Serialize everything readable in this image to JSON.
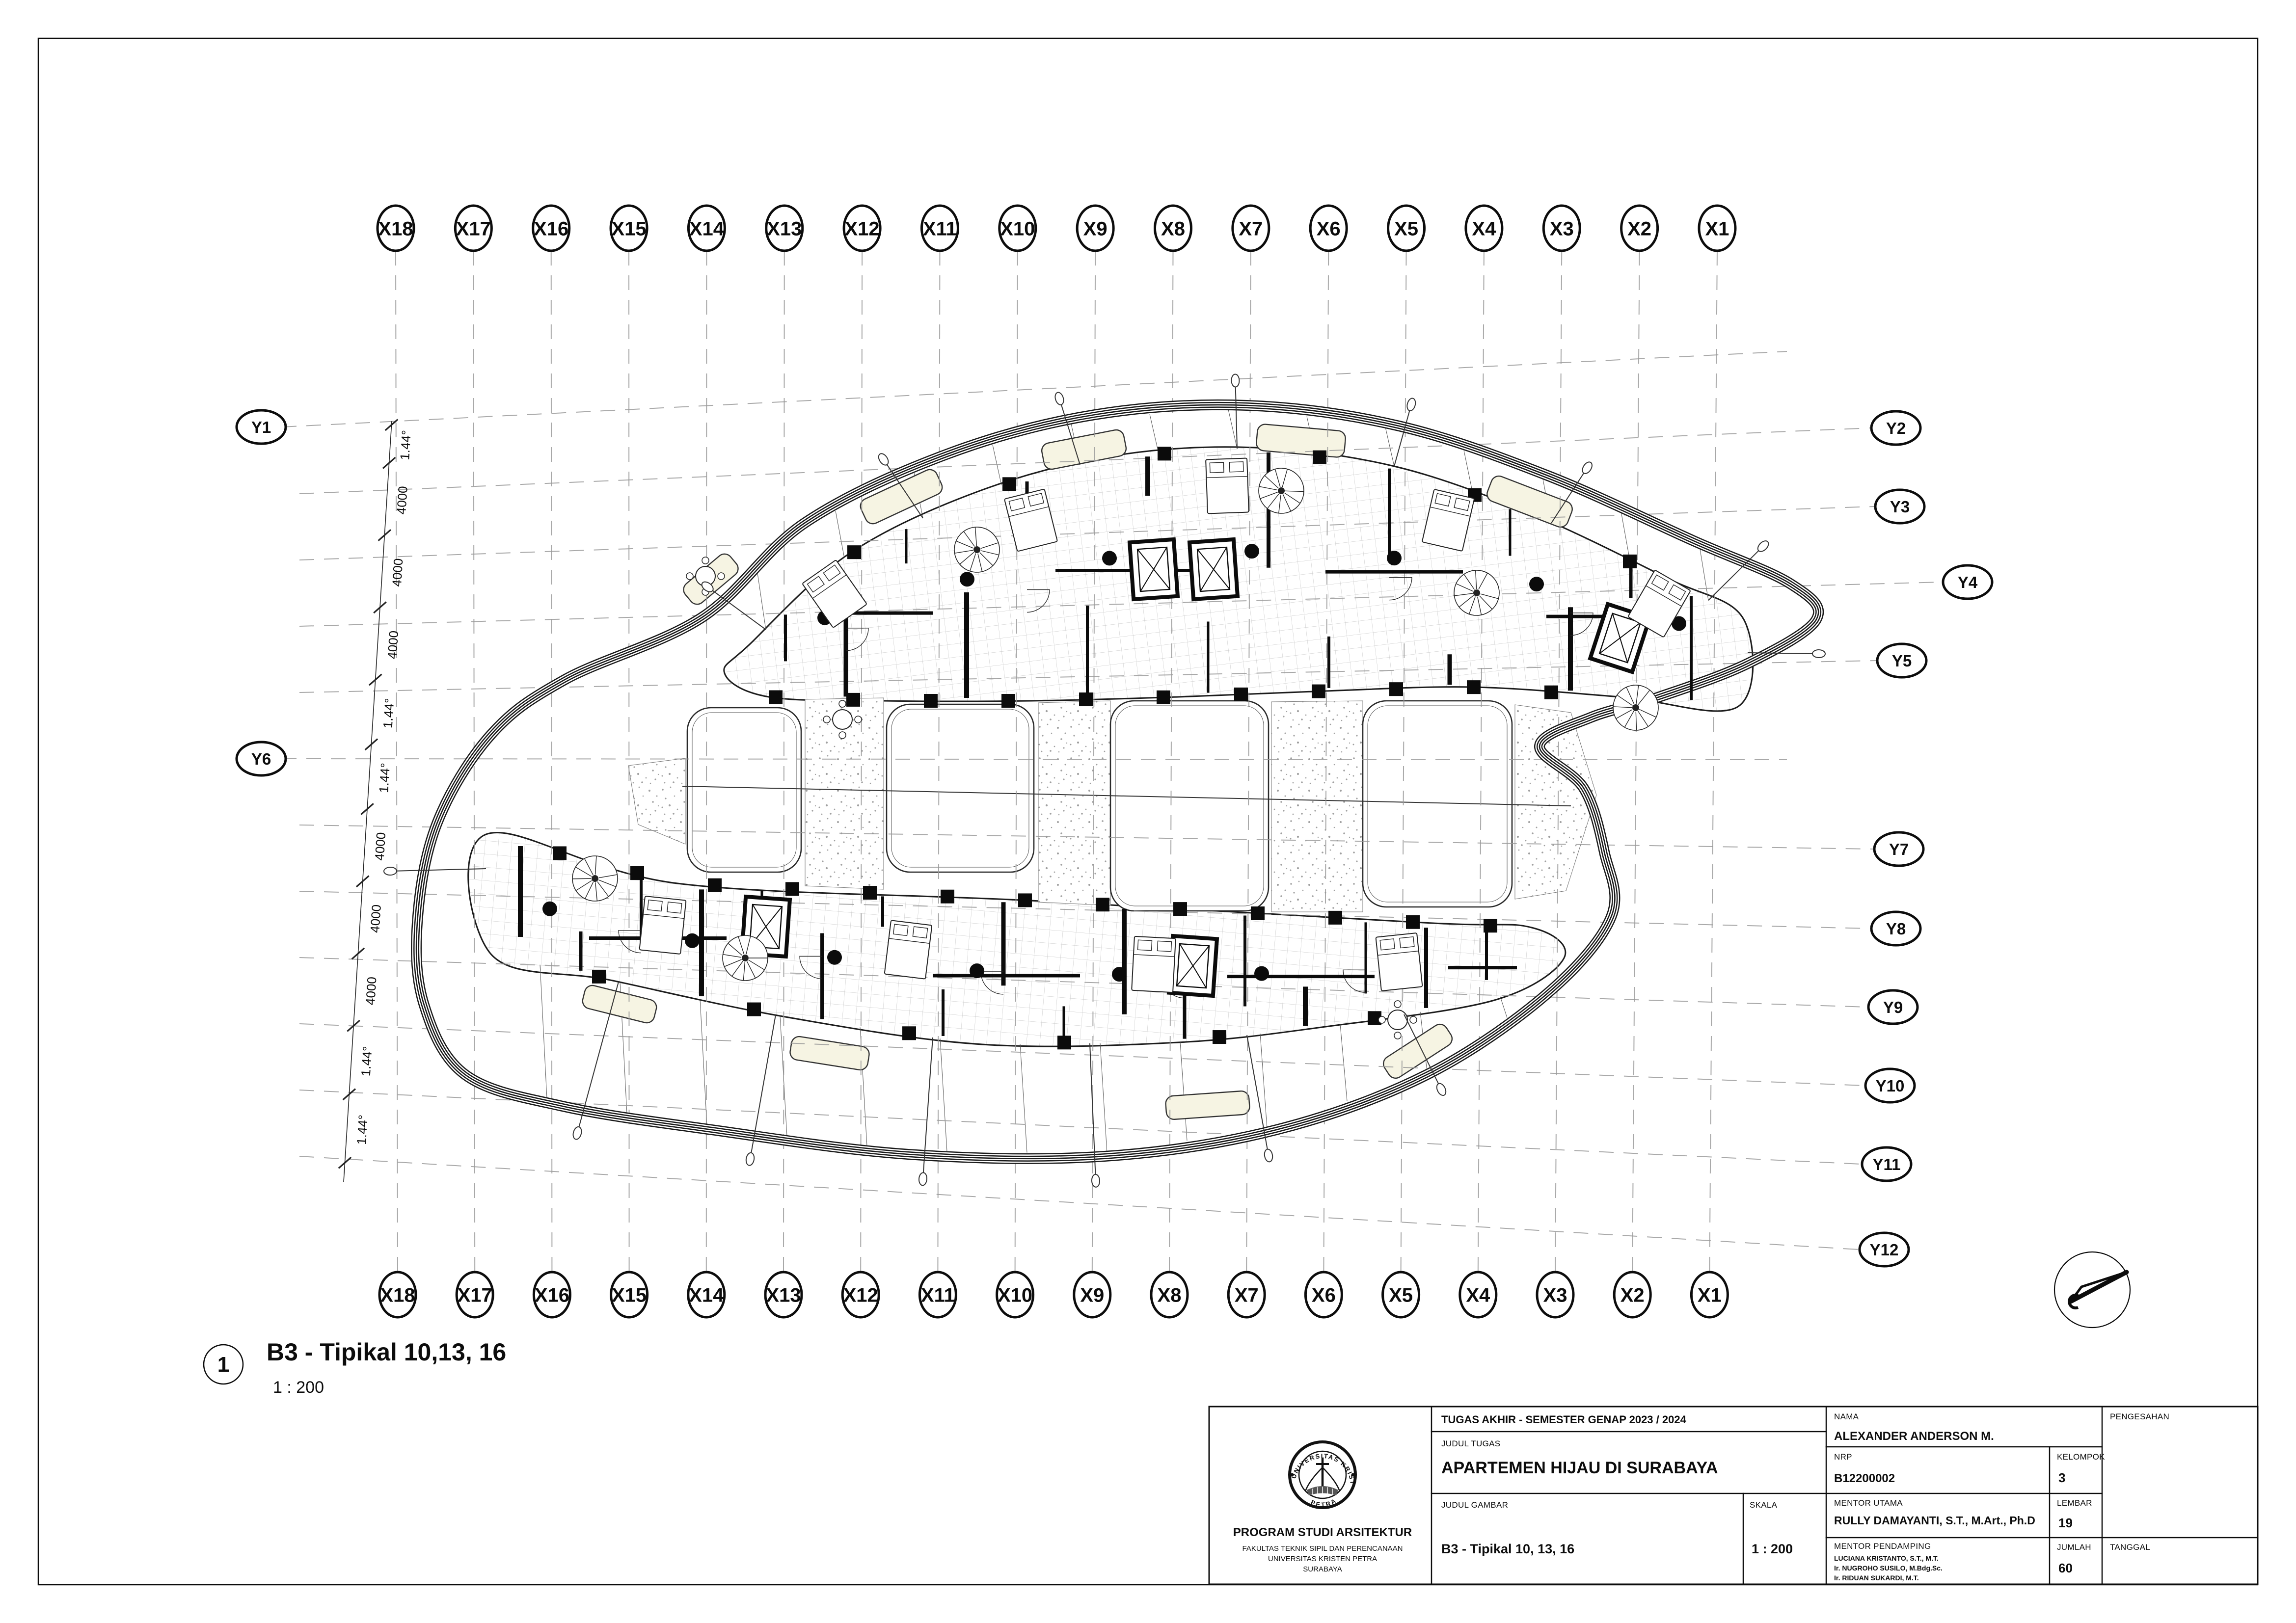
{
  "drawing_label": {
    "number": "1",
    "title": "B3 - Tipikal 10,13, 16",
    "scale": "1 : 200"
  },
  "grid": {
    "x_labels": [
      "X18",
      "X17",
      "X16",
      "X15",
      "X14",
      "X13",
      "X12",
      "X11",
      "X10",
      "X9",
      "X8",
      "X7",
      "X6",
      "X5",
      "X4",
      "X3",
      "X2",
      "X1"
    ],
    "y_labels": [
      {
        "label": "Y1",
        "side": "left"
      },
      {
        "label": "Y2",
        "side": "right"
      },
      {
        "label": "Y3",
        "side": "right"
      },
      {
        "label": "Y4",
        "side": "right"
      },
      {
        "label": "Y5",
        "side": "right"
      },
      {
        "label": "Y6",
        "side": "left"
      },
      {
        "label": "Y7",
        "side": "right"
      },
      {
        "label": "Y8",
        "side": "right"
      },
      {
        "label": "Y9",
        "side": "right"
      },
      {
        "label": "Y10",
        "side": "right"
      },
      {
        "label": "Y11",
        "side": "right"
      },
      {
        "label": "Y12",
        "side": "right"
      }
    ],
    "dimension_labels": [
      "1.44°",
      "4000",
      "4000",
      "4000",
      "1.44°",
      "1.44°",
      "4000",
      "4000",
      "4000",
      "1.44°",
      "1.44°"
    ]
  },
  "title_block": {
    "header": "TUGAS AKHIR - SEMESTER GENAP 2023 / 2024",
    "institution": {
      "program": "PROGRAM STUDI ARSITEKTUR",
      "faculty": "FAKULTAS TEKNIK SIPIL DAN PERENCANAAN",
      "university": "UNIVERSITAS KRISTEN PETRA",
      "city": "SURABAYA"
    },
    "logo": {
      "ring_top": "UNIVERSITAS KRISTEN",
      "ring_bottom": "PETRA"
    },
    "labels": {
      "judul_tugas": "JUDUL TUGAS",
      "judul_gambar": "JUDUL GAMBAR",
      "skala": "SKALA",
      "nama": "NAMA",
      "nrp": "NRP",
      "kelompok": "KELOMPOK",
      "mentor_utama": "MENTOR UTAMA",
      "mentor_pendamping": "MENTOR PENDAMPING",
      "lembar": "LEMBAR",
      "jumlah": "JUMLAH",
      "pengesahan": "PENGESAHAN",
      "tanggal": "TANGGAL"
    },
    "values": {
      "judul_tugas": "APARTEMEN HIJAU DI SURABAYA",
      "judul_gambar": "B3 - Tipikal 10, 13, 16",
      "skala": "1 : 200",
      "nama": "ALEXANDER ANDERSON M.",
      "nrp": "B12200002",
      "kelompok": "3",
      "mentor_utama": "RULLY DAMAYANTI, S.T., M.Art., Ph.D",
      "mentor_pendamping": [
        "LUCIANA KRISTANTO, S.T., M.T.",
        "Ir. NUGROHO SUSILO, M.Bdg.Sc.",
        "Ir. RIDUAN SUKARDI, M.T."
      ],
      "lembar": "19",
      "jumlah": "60"
    }
  },
  "colors": {
    "balcony_pad": "#f6f4e3",
    "grid_line": "#9a9a9a",
    "wall": "#0b0b0b",
    "tile_line": "#c3c3c3",
    "stipple_dot": "#8f8f8f"
  }
}
